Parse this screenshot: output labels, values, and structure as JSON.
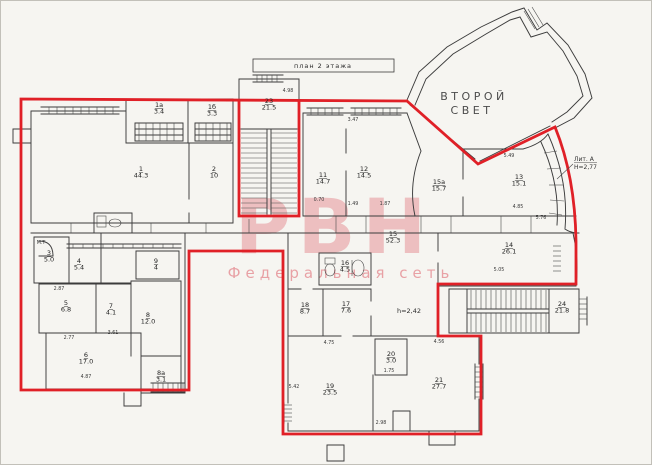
{
  "title_box": {
    "label": "план 2 этажа"
  },
  "watermark": {
    "brand": "РВН",
    "subtitle": "Федеральная сеть"
  },
  "annotations": {
    "second_light_line1": "ВТОРОЙ",
    "second_light_line2": "СВЕТ",
    "liter_line1": "Лит. А",
    "liter_line2": "Н=2,77",
    "ceiling_height": "h=2,42"
  },
  "rooms": [
    {
      "num": "1",
      "area": "44.3",
      "x": 140,
      "y": 170
    },
    {
      "num": "1а",
      "area": "3.4",
      "x": 158,
      "y": 106
    },
    {
      "num": "1б",
      "area": "3.3",
      "x": 211,
      "y": 108
    },
    {
      "num": "2",
      "area": "10",
      "x": 213,
      "y": 170
    },
    {
      "num": "23",
      "area": "21.5",
      "x": 268,
      "y": 102
    },
    {
      "num": "11",
      "area": "14.7",
      "x": 322,
      "y": 176
    },
    {
      "num": "12",
      "area": "14.5",
      "x": 363,
      "y": 170
    },
    {
      "num": "15а",
      "area": "15.7",
      "x": 438,
      "y": 183
    },
    {
      "num": "13",
      "area": "15.1",
      "x": 518,
      "y": 178
    },
    {
      "num": "3",
      "area": "5.0",
      "x": 48,
      "y": 254
    },
    {
      "num": "4",
      "area": "5.4",
      "x": 78,
      "y": 262
    },
    {
      "num": "9",
      "area": "4",
      "x": 155,
      "y": 262
    },
    {
      "num": "5",
      "area": "6.8",
      "x": 65,
      "y": 304
    },
    {
      "num": "7",
      "area": "4.1",
      "x": 110,
      "y": 307
    },
    {
      "num": "8",
      "area": "12.0",
      "x": 147,
      "y": 316
    },
    {
      "num": "6",
      "area": "17.0",
      "x": 85,
      "y": 356
    },
    {
      "num": "8а",
      "area": "3.1",
      "x": 160,
      "y": 374
    },
    {
      "num": "18",
      "area": "8.7",
      "x": 304,
      "y": 306
    },
    {
      "num": "17",
      "area": "7.6",
      "x": 345,
      "y": 305
    },
    {
      "num": "16",
      "area": "4.5",
      "x": 344,
      "y": 264
    },
    {
      "num": "15",
      "area": "52.3",
      "x": 392,
      "y": 235
    },
    {
      "num": "14",
      "area": "26.1",
      "x": 508,
      "y": 246
    },
    {
      "num": "24",
      "area": "21.8",
      "x": 561,
      "y": 305
    },
    {
      "num": "19",
      "area": "23.5",
      "x": 329,
      "y": 387
    },
    {
      "num": "20",
      "area": "3.0",
      "x": 390,
      "y": 355
    },
    {
      "num": "21",
      "area": "27.7",
      "x": 438,
      "y": 381
    }
  ],
  "dims": [
    {
      "t": "4.98",
      "x": 287,
      "y": 91
    },
    {
      "t": "0.70",
      "x": 318,
      "y": 200
    },
    {
      "t": "1.49",
      "x": 352,
      "y": 204
    },
    {
      "t": "1.87",
      "x": 384,
      "y": 204
    },
    {
      "t": "3.47",
      "x": 352,
      "y": 120
    },
    {
      "t": "5.49",
      "x": 508,
      "y": 156
    },
    {
      "t": "4.85",
      "x": 517,
      "y": 207
    },
    {
      "t": "5.05",
      "x": 498,
      "y": 270
    },
    {
      "t": "5.76",
      "x": 540,
      "y": 218
    },
    {
      "t": "М.Т",
      "x": 40,
      "y": 243
    },
    {
      "t": "2.87",
      "x": 58,
      "y": 289
    },
    {
      "t": "2.77",
      "x": 68,
      "y": 338
    },
    {
      "t": "4.87",
      "x": 85,
      "y": 377
    },
    {
      "t": "3.61",
      "x": 112,
      "y": 333
    },
    {
      "t": "4.75",
      "x": 328,
      "y": 343
    },
    {
      "t": "4.56",
      "x": 438,
      "y": 342
    },
    {
      "t": "1.75",
      "x": 388,
      "y": 371
    },
    {
      "t": "2.98",
      "x": 380,
      "y": 423
    },
    {
      "t": "5.42",
      "x": 293,
      "y": 387
    }
  ],
  "colors": {
    "outline_red": "#e02027",
    "wall_ink": "#3c3c3c",
    "watermark_pink": "#e8949b",
    "paper": "#f6f5f1"
  }
}
